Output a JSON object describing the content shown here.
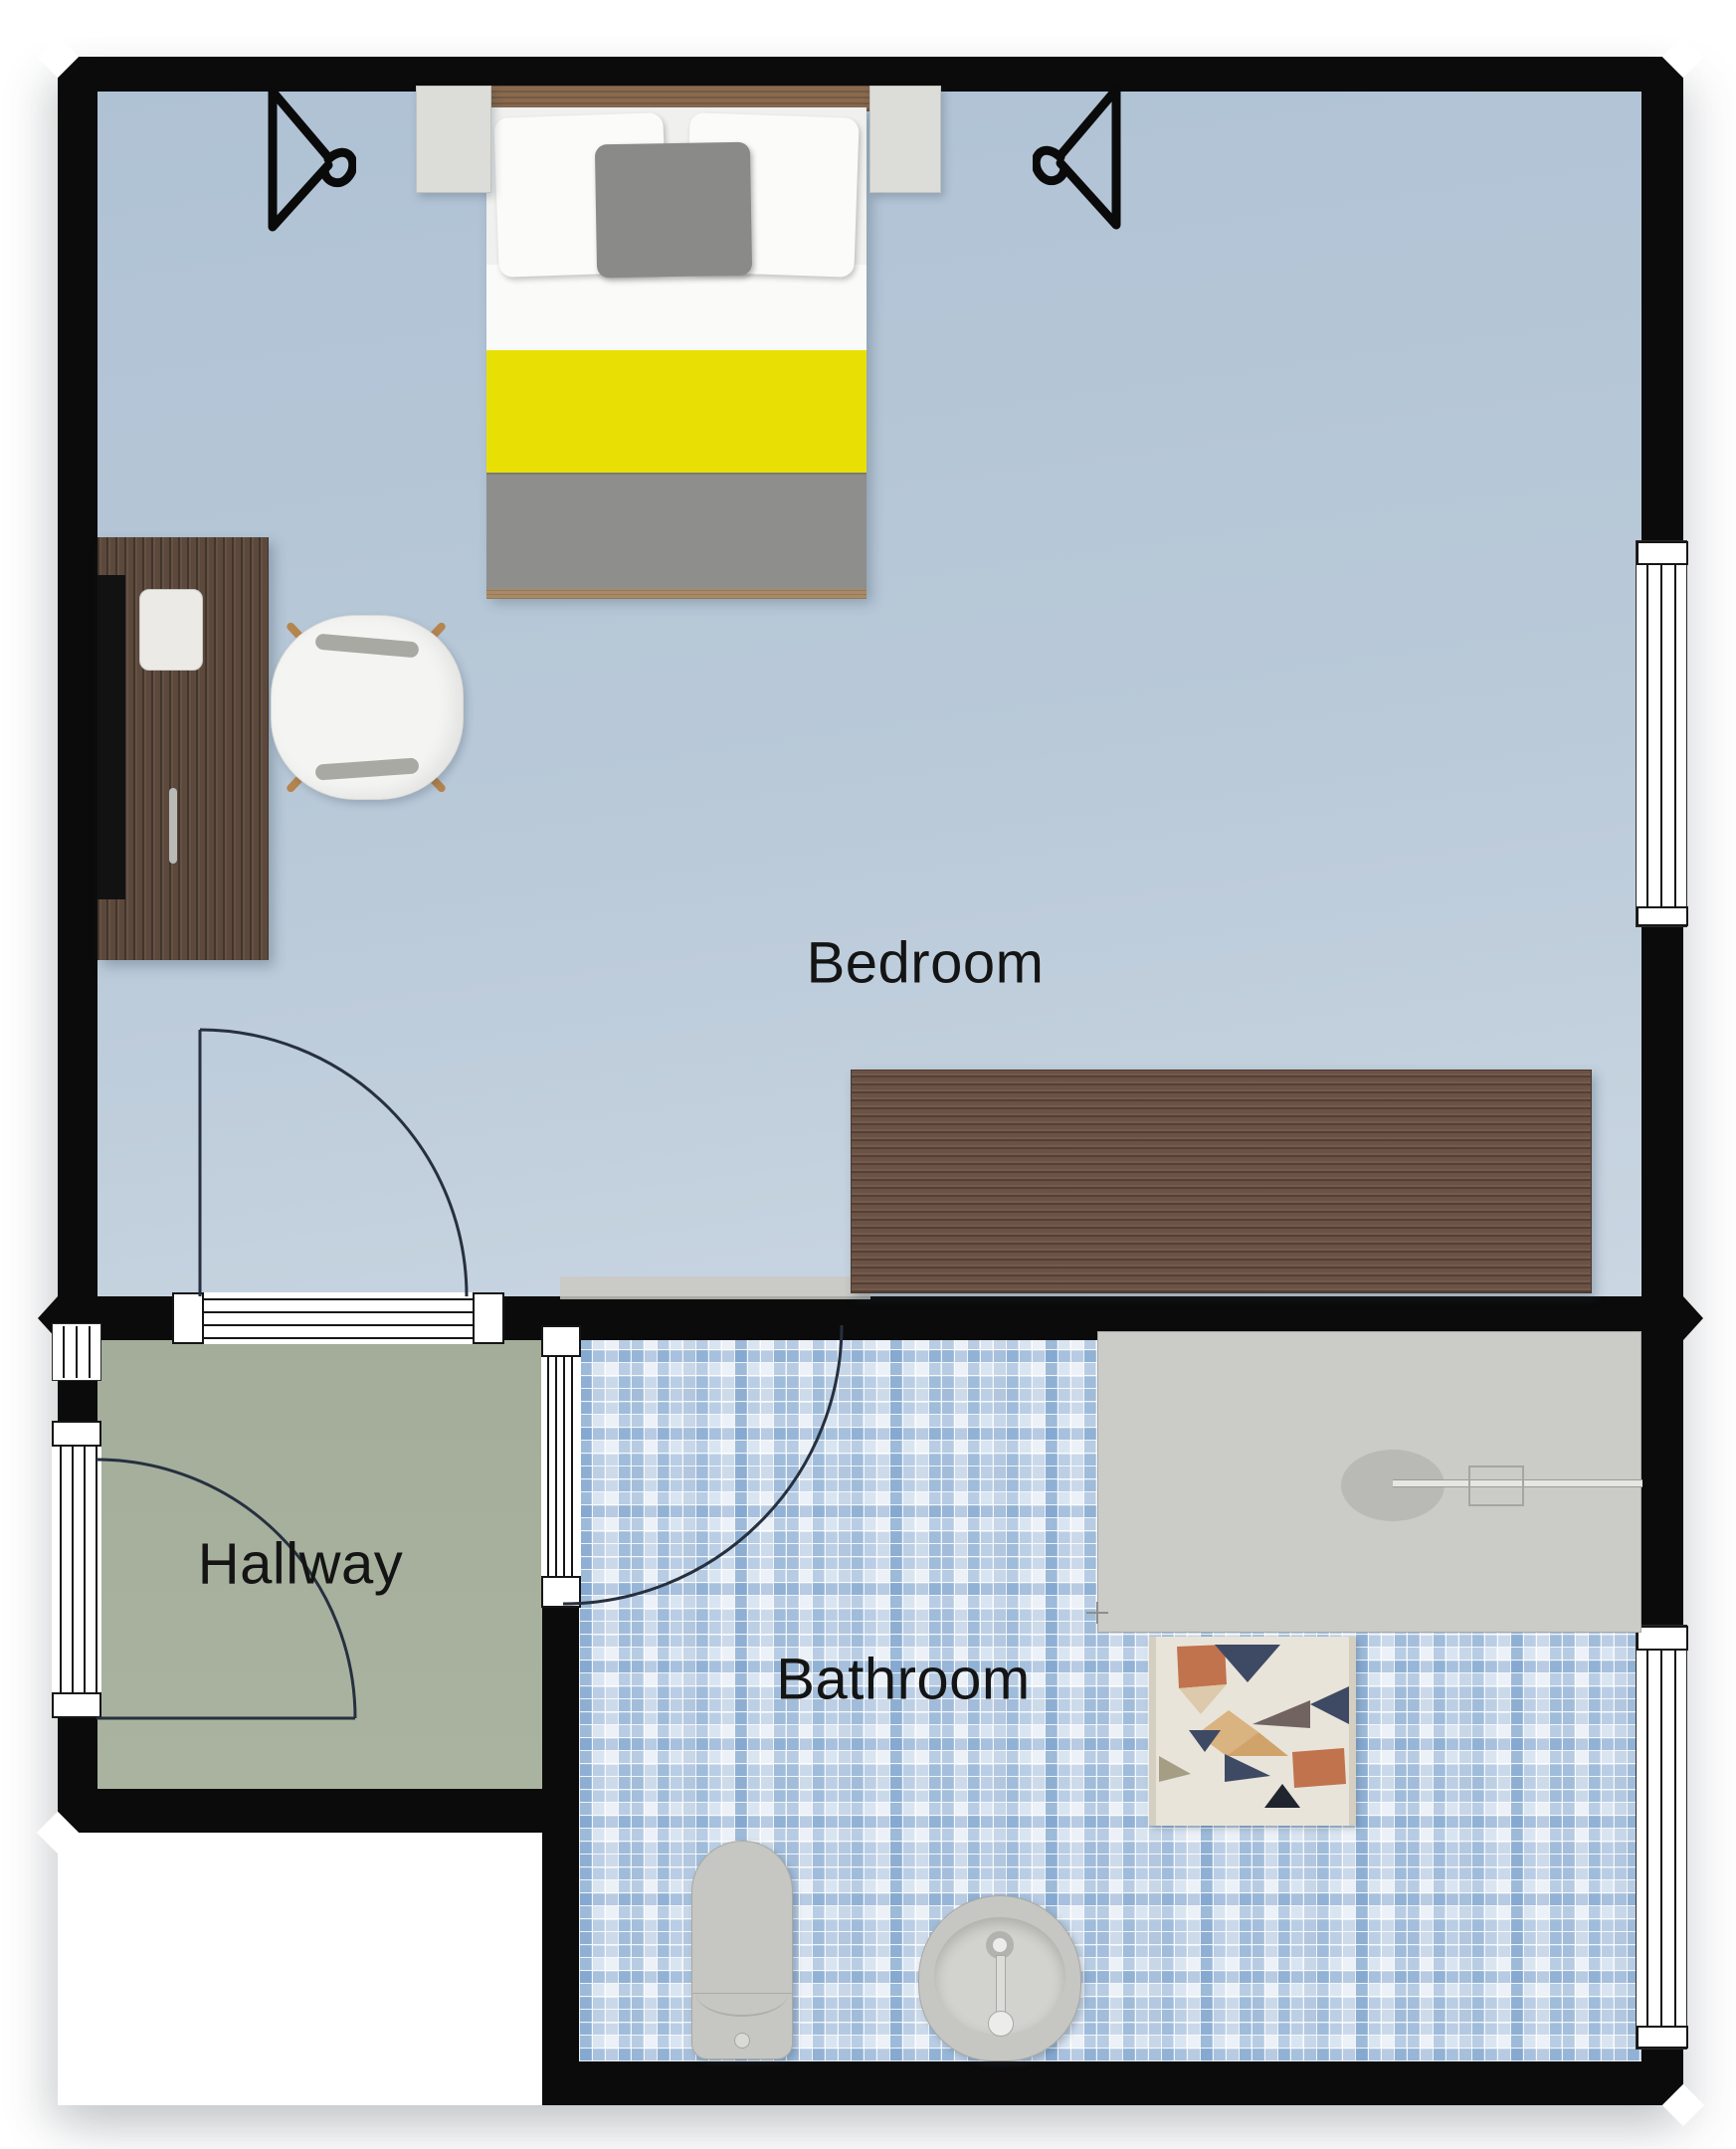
{
  "rooms": [
    {
      "id": "bedroom",
      "label": "Bedroom"
    },
    {
      "id": "hallway",
      "label": "Hallway"
    },
    {
      "id": "bathroom",
      "label": "Bathroom"
    }
  ],
  "palette": {
    "wall": "#0b0b0b",
    "bedroom_floor": "#b6c8d8",
    "hallway_floor": "#a7b09d",
    "bathroom_tile_base": "#e8eef5",
    "bathroom_tile_accent": "#7fa8d0",
    "bed_blanket_yellow": "#e8e004",
    "bed_blanket_gray": "#8e8e8c",
    "wood_desk": "#5c493c",
    "wood_dresser": "#6b5244",
    "wood_headboard": "#8a6a4e",
    "fixture_gray": "#c6c6c2",
    "door_arc": "#26303e",
    "mat_colors": [
      "#e9e4da",
      "#c0734d",
      "#3e4a63",
      "#d9b380",
      "#cfa369",
      "#20242e",
      "#a59e85",
      "#716360"
    ]
  },
  "furniture": {
    "bedroom": [
      "double-bed",
      "nightstand-left",
      "nightstand-right",
      "clothes-hanger-left",
      "clothes-hanger-right",
      "desk",
      "desk-chair",
      "dresser"
    ],
    "bathroom": [
      "shower",
      "bath-mat",
      "toilet",
      "sink"
    ],
    "doors": [
      "bedroom-door",
      "hallway-entry-door",
      "bathroom-door"
    ],
    "windows": [
      "bedroom-right-window",
      "bathroom-right-window",
      "hallway-left-window",
      "hallway-entry-opening"
    ]
  }
}
